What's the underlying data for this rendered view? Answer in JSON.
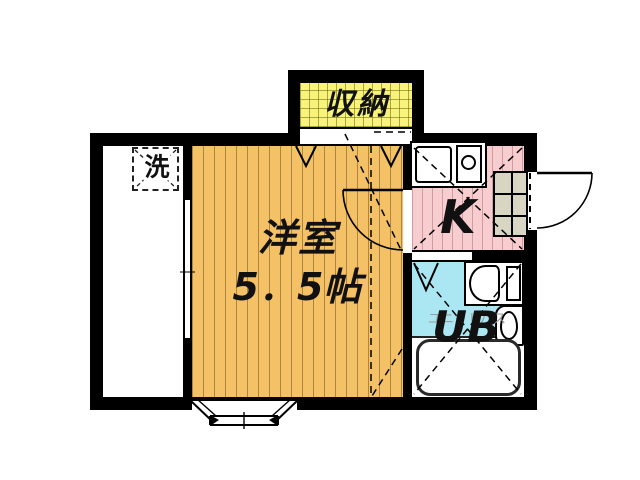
{
  "plan": {
    "storage": {
      "label": "収納"
    },
    "entry": {
      "washer_label": "洗"
    },
    "western_room": {
      "label": "洋室",
      "size": "5．5帖"
    },
    "kitchen": {
      "label": "K"
    },
    "unit_bath": {
      "label": "UB",
      "ghost_label": "ユニットバス"
    }
  },
  "colors": {
    "background": "#ffffff",
    "wall": "#000000",
    "storage_fill": "#f8f37b",
    "western_room_fill": "#f4c167",
    "kitchen_fill": "#f7cdd0",
    "unit_bath_fill": "#aae7f3",
    "cabinet_fill": "#d9d5c3"
  }
}
